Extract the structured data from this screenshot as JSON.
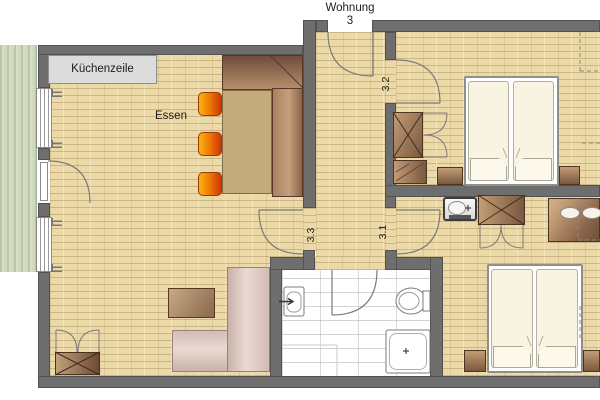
{
  "entrance": {
    "label_line1": "Wohnung",
    "label_line2": "3"
  },
  "kitchen": {
    "label": "Küchenzeile"
  },
  "dining": {
    "label": "Essen"
  },
  "room_numbers": {
    "hall_door": "3.2",
    "living_door": "3.3",
    "bedroom_door": "3.1"
  },
  "colors": {
    "wall": "#6e6e6e",
    "wall_edge": "#525252",
    "floor": "#ecd9a8",
    "terrace": "#cfd9bc",
    "tile": "#ffffff",
    "kitchen_unit": "#dcdcdc",
    "chair_a": "#f6b40e",
    "chair_b": "#cf3708",
    "bench_dark": "#6e4d3a",
    "bench_light": "#b88f6d",
    "table": "#c3ab7e",
    "sofa_dark": "#c9b2aa",
    "sofa_light": "#e9dad3",
    "wood_dark": "#7a5840",
    "wood_light": "#c29c76",
    "mattress": "#f9f4e1",
    "line": "#7b7b7b",
    "text": "#1c1c1c"
  }
}
